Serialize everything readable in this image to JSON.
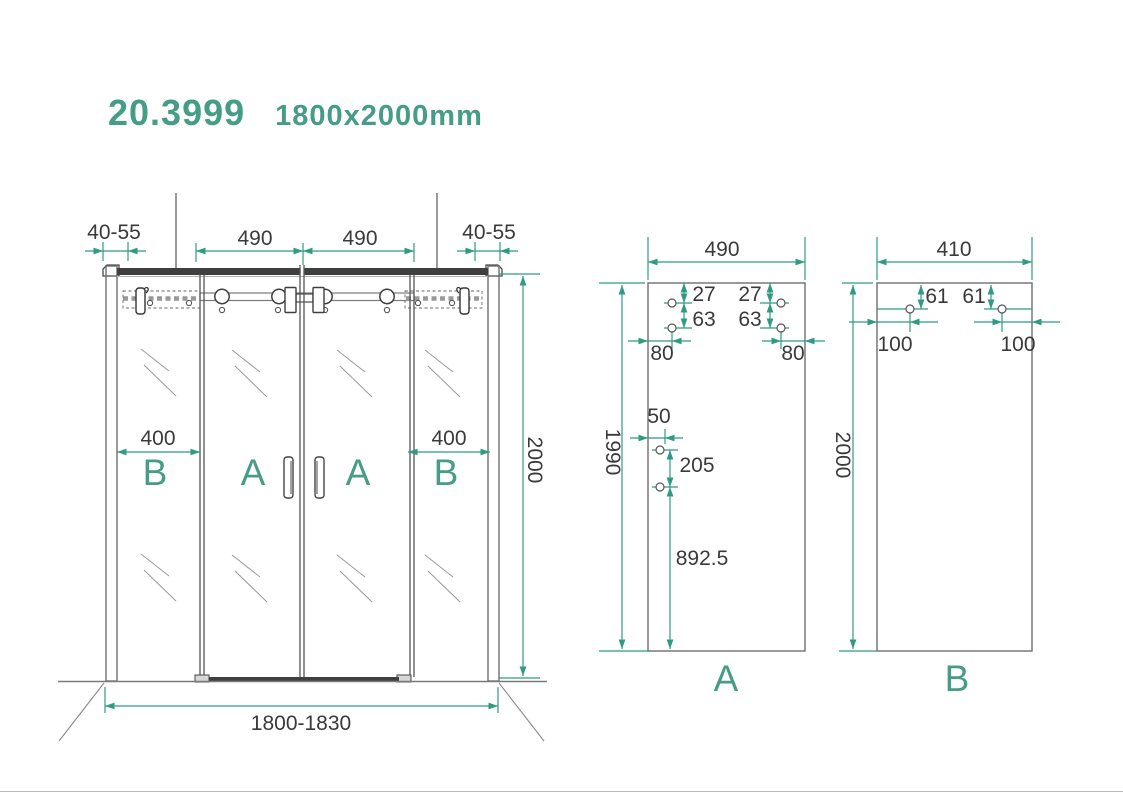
{
  "title": {
    "model": "20.3999",
    "size": "1800x2000mm"
  },
  "front_view": {
    "panel_labels": {
      "b_left": "B",
      "a_left": "A",
      "a_right": "A",
      "b_right": "B"
    },
    "dimensions": {
      "wall_profile_left": "40-55",
      "wall_profile_right": "40-55",
      "door_width_left": "490",
      "door_width_right": "490",
      "fixed_panel_left": "400",
      "fixed_panel_right": "400",
      "height": "2000",
      "total_width": "1800-1830"
    }
  },
  "panel_a": {
    "label": "A",
    "dimensions": {
      "width": "490",
      "height": "1990",
      "hole_top_left": "27",
      "hole_gap_left": "63",
      "hole_top_right": "27",
      "hole_gap_right": "63",
      "hole_edge_left": "80",
      "hole_edge_right": "80",
      "handle_edge": "50",
      "handle_spacing": "205",
      "handle_bottom": "892.5"
    }
  },
  "panel_b": {
    "label": "B",
    "dimensions": {
      "width": "410",
      "height": "2000",
      "hole_top_left": "61",
      "hole_top_right": "61",
      "hole_edge_left": "100",
      "hole_edge_right": "100"
    }
  },
  "colors": {
    "accent_line": "#2E9B82",
    "accent_text": "#479C87",
    "drawing_line": "#6E6E6E",
    "dark_rail": "#3F3F3F",
    "dimension_text": "#3A3A3A"
  }
}
